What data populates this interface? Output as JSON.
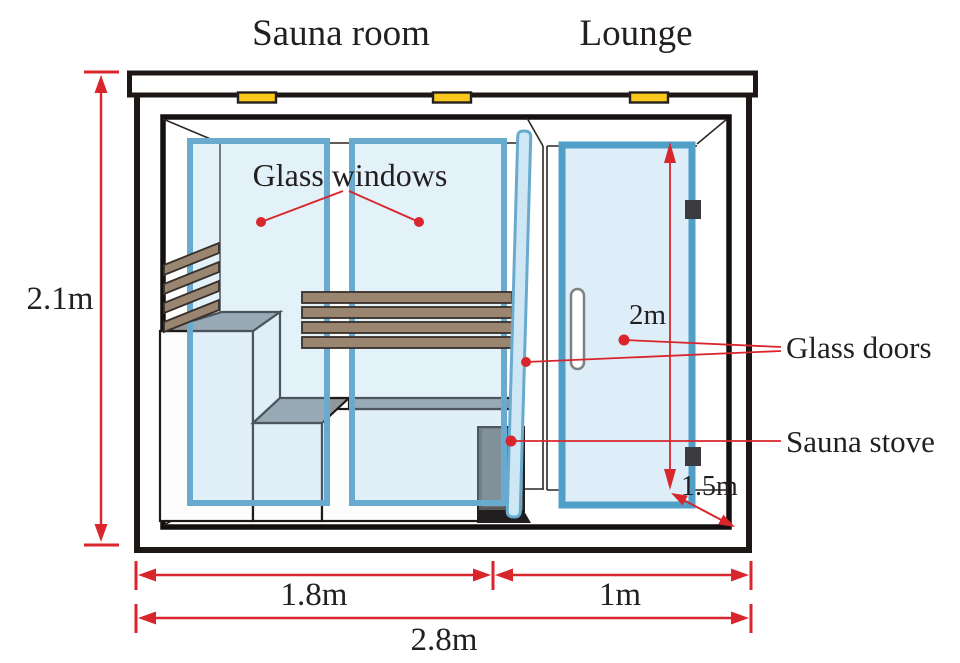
{
  "diagram": {
    "title_labels": {
      "sauna_room": "Sauna room",
      "lounge": "Lounge"
    },
    "callouts": {
      "glass_windows": "Glass windows",
      "glass_doors": "Glass doors",
      "sauna_stove": "Sauna stove"
    },
    "dimensions": {
      "overall_height": "2.1m",
      "glass_door_height": "2m",
      "cabin_depth": "1.5m",
      "sauna_room_width": "1.8m",
      "lounge_width": "1m",
      "overall_width": "2.8m"
    },
    "colors": {
      "dimension_red": "#d8262c",
      "glass_frame_blue": "#68abce",
      "glass_fill_blue": "#ddeef8",
      "wood_slat_brown": "#9a8570",
      "bench_top_gray": "#8f979c",
      "ceiling_light_yellow": "#f8c81c",
      "outline_black": "#231f20",
      "stove_gray": "#58595b"
    }
  }
}
